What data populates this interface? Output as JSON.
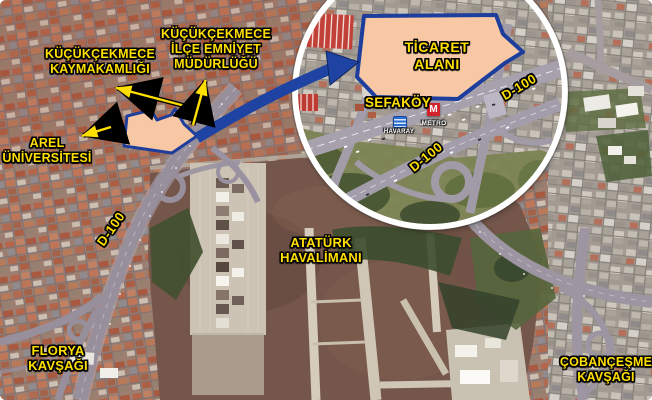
{
  "colors": {
    "label-yellow": "#FFDF00",
    "polygon-fill": "#F7C8A3",
    "polygon-border": "#1D3E9C",
    "arrow-blue": "#1E43A3",
    "metro-red": "#D2232A",
    "havaray-blue": "#2A6FD4"
  },
  "main_map": {
    "labels": {
      "kaymakamlik": "KÜÇÜKÇEKMECE\nKAYMAKAMLIĞI",
      "emniyet": "KÜÇÜKÇEKMECE\nİLÇE EMNİYET\nMÜDÜRLÜĞÜ",
      "arel": "AREL\nÜNİVERSİTESİ",
      "d100": "D-100",
      "ataturk": "ATATÜRK\nHAVALİMANI",
      "florya": "FLORYA\nKAVŞAĞI",
      "cobancesme": "ÇOBANÇEŞME\nKAVŞAĞI"
    }
  },
  "inset": {
    "labels": {
      "ticaret": "TİCARET\nALANI",
      "sefakoy": "SEFAKÖY",
      "d100_upper": "D-100",
      "d100_lower": "D-100",
      "havaray": "HAVARAY",
      "metro": "METRO"
    },
    "icons": {
      "metro_letter": "M"
    }
  }
}
